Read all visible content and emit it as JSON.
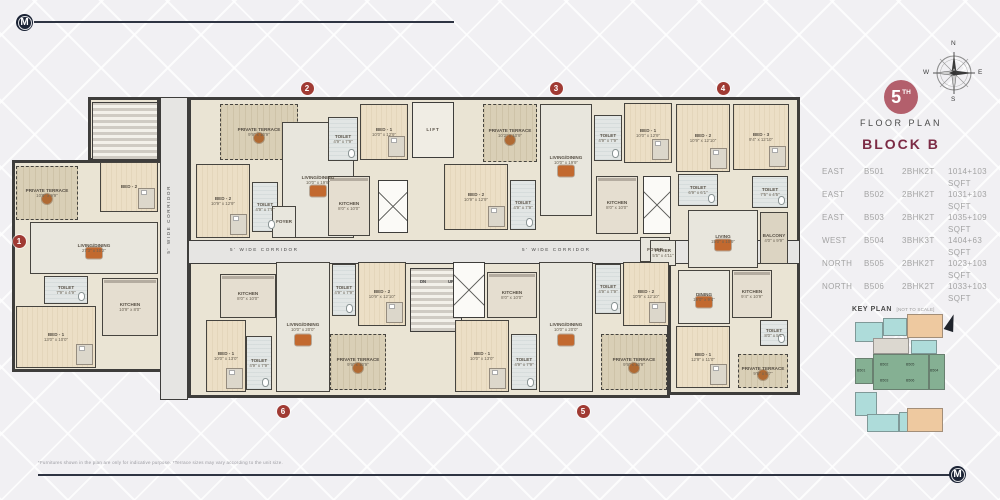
{
  "branding": {
    "logo_letter": "M"
  },
  "header": {
    "floor_number": "5",
    "floor_ordinal": "TH",
    "floor_caption": "FLOOR PLAN",
    "block_title": "BLOCK B"
  },
  "compass": {
    "north": "N",
    "east": "E",
    "south": "S",
    "west": "W"
  },
  "units_table": [
    {
      "facing": "EAST",
      "unit_no": "B501",
      "unit_type": "2BHK2T",
      "area": "1014+103 SQFT"
    },
    {
      "facing": "EAST",
      "unit_no": "B502",
      "unit_type": "2BHK2T",
      "area": "1031+103 SQFT"
    },
    {
      "facing": "EAST",
      "unit_no": "B503",
      "unit_type": "2BHK2T",
      "area": "1035+109 SQFT"
    },
    {
      "facing": "WEST",
      "unit_no": "B504",
      "unit_type": "3BHK3T",
      "area": "1404+63 SQFT"
    },
    {
      "facing": "NORTH",
      "unit_no": "B505",
      "unit_type": "2BHK2T",
      "area": "1023+103 SQFT"
    },
    {
      "facing": "NORTH",
      "unit_no": "B506",
      "unit_type": "2BHK2T",
      "area": "1033+103 SQFT"
    }
  ],
  "key_plan": {
    "title": "KEY PLAN",
    "subtitle": "[NOT TO SCALE]",
    "north_label": "N",
    "blocks": [
      {
        "x": 2,
        "y": 10,
        "w": 28,
        "h": 20,
        "c": "cyan"
      },
      {
        "x": 30,
        "y": 6,
        "w": 24,
        "h": 18,
        "c": "cyan"
      },
      {
        "x": 54,
        "y": 2,
        "w": 36,
        "h": 24,
        "c": "orange"
      },
      {
        "x": 20,
        "y": 26,
        "w": 36,
        "h": 16,
        "c": "gray"
      },
      {
        "x": 58,
        "y": 28,
        "w": 26,
        "h": 14,
        "c": "cyan"
      },
      {
        "x": 2,
        "y": 46,
        "w": 18,
        "h": 26,
        "c": "green"
      },
      {
        "x": 20,
        "y": 42,
        "w": 56,
        "h": 36,
        "c": "green"
      },
      {
        "x": 76,
        "y": 42,
        "w": 16,
        "h": 36,
        "c": "green"
      },
      {
        "x": 2,
        "y": 80,
        "w": 22,
        "h": 24,
        "c": "cyan"
      },
      {
        "x": 46,
        "y": 100,
        "w": 26,
        "h": 20,
        "c": "cyan"
      },
      {
        "x": 14,
        "y": 102,
        "w": 32,
        "h": 18,
        "c": "cyan"
      },
      {
        "x": 54,
        "y": 96,
        "w": 36,
        "h": 24,
        "c": "orange"
      }
    ],
    "labels": [
      {
        "t": "B501",
        "x": 4,
        "y": 56
      },
      {
        "t": "B502",
        "x": 27,
        "y": 50
      },
      {
        "t": "B505",
        "x": 53,
        "y": 50
      },
      {
        "t": "B503",
        "x": 27,
        "y": 66
      },
      {
        "t": "B506",
        "x": 53,
        "y": 66
      },
      {
        "t": "B504",
        "x": 77,
        "y": 56
      }
    ]
  },
  "floor_plan": {
    "corridor_label": "5' WIDE CORRIDOR",
    "lift_label": "LIFT",
    "stair_labels": [
      {
        "t": "DN",
        "x": 420,
        "y": 279
      },
      {
        "t": "UP",
        "x": 448,
        "y": 279
      }
    ],
    "badges": [
      {
        "n": "1",
        "x": 19,
        "y": 241
      },
      {
        "n": "2",
        "x": 307,
        "y": 88
      },
      {
        "n": "3",
        "x": 556,
        "y": 88
      },
      {
        "n": "4",
        "x": 723,
        "y": 88
      },
      {
        "n": "5",
        "x": 583,
        "y": 411
      },
      {
        "n": "6",
        "x": 283,
        "y": 411
      }
    ],
    "blocks": [
      {
        "x": 88,
        "y": 97,
        "w": 72,
        "h": 64
      },
      {
        "x": 188,
        "y": 97,
        "w": 612,
        "h": 146
      },
      {
        "x": 12,
        "y": 160,
        "w": 176,
        "h": 212
      },
      {
        "x": 188,
        "y": 258,
        "w": 482,
        "h": 140
      },
      {
        "x": 668,
        "y": 243,
        "w": 132,
        "h": 152
      }
    ],
    "corridors": [
      {
        "x": 160,
        "y": 97,
        "w": 28,
        "h": 303
      },
      {
        "x": 188,
        "y": 240,
        "w": 612,
        "h": 24
      }
    ],
    "corridor_labels": [
      {
        "x": 230,
        "y": 247,
        "v": false
      },
      {
        "x": 522,
        "y": 247,
        "v": false
      },
      {
        "x": 166,
        "y": 185,
        "v": true
      }
    ],
    "cores": [
      {
        "kind": "lift",
        "x": 412,
        "y": 102,
        "w": 42,
        "h": 56
      },
      {
        "kind": "stair",
        "x": 410,
        "y": 268,
        "w": 52,
        "h": 64
      },
      {
        "kind": "stair",
        "x": 92,
        "y": 102,
        "w": 66,
        "h": 58
      },
      {
        "kind": "shaft",
        "x": 378,
        "y": 180,
        "w": 30,
        "h": 53
      },
      {
        "kind": "shaft",
        "x": 643,
        "y": 176,
        "w": 28,
        "h": 58
      },
      {
        "kind": "shaft",
        "x": 453,
        "y": 262,
        "w": 32,
        "h": 56
      }
    ],
    "rooms": [
      {
        "u": 1,
        "k": "terrace",
        "n": "PRIVATE TERRACE",
        "d": "10'8\" x 9'9\"",
        "x": 16,
        "y": 166,
        "w": 62,
        "h": 54
      },
      {
        "u": 1,
        "k": "bed",
        "n": "BED - 2",
        "d": "",
        "x": 100,
        "y": 162,
        "w": 58,
        "h": 50
      },
      {
        "u": 1,
        "k": "living",
        "n": "LIVING/DINING",
        "d": "27'3\" x 10'2\"",
        "x": 30,
        "y": 222,
        "w": 128,
        "h": 52
      },
      {
        "u": 1,
        "k": "toilet",
        "n": "TOILET",
        "d": "7'9\" x 4'9\"",
        "x": 44,
        "y": 276,
        "w": 44,
        "h": 28
      },
      {
        "u": 1,
        "k": "bed",
        "n": "BED - 1",
        "d": "13'0\" x 10'0\"",
        "x": 16,
        "y": 306,
        "w": 80,
        "h": 62
      },
      {
        "u": 1,
        "k": "kitchen",
        "n": "KITCHEN",
        "d": "10'9\" x 8'0\"",
        "x": 102,
        "y": 278,
        "w": 56,
        "h": 58
      },
      {
        "u": 2,
        "k": "terrace",
        "n": "PRIVATE TERRACE",
        "d": "9'9\" x 10'9\"",
        "x": 220,
        "y": 104,
        "w": 78,
        "h": 56
      },
      {
        "u": 2,
        "k": "bed",
        "n": "BED - 2",
        "d": "10'9\" x 12'9\"",
        "x": 196,
        "y": 164,
        "w": 54,
        "h": 74
      },
      {
        "u": 2,
        "k": "toilet",
        "n": "TOILET",
        "d": "4'9\" x 7'9\"",
        "x": 252,
        "y": 182,
        "w": 26,
        "h": 50
      },
      {
        "u": 2,
        "k": "living",
        "n": "LIVING/DINING",
        "d": "10'0\" x 19'9\"",
        "x": 282,
        "y": 122,
        "w": 72,
        "h": 116
      },
      {
        "u": 2,
        "k": "toilet",
        "n": "TOILET",
        "d": "4'9\" x 7'9\"",
        "x": 328,
        "y": 117,
        "w": 30,
        "h": 44
      },
      {
        "u": 2,
        "k": "bed",
        "n": "BED - 1",
        "d": "10'0\" x 12'9\"",
        "x": 360,
        "y": 104,
        "w": 48,
        "h": 56
      },
      {
        "u": 2,
        "k": "kitchen",
        "n": "KITCHEN",
        "d": "8'0\" x 10'0\"",
        "x": 328,
        "y": 176,
        "w": 42,
        "h": 60
      },
      {
        "u": 2,
        "k": "foyer",
        "n": "FOYER",
        "d": "",
        "x": 272,
        "y": 206,
        "w": 24,
        "h": 32
      },
      {
        "u": 3,
        "k": "terrace",
        "n": "PRIVATE TERRACE",
        "d": "10'2\" x 10'9\"",
        "x": 483,
        "y": 104,
        "w": 54,
        "h": 58
      },
      {
        "u": 3,
        "k": "living",
        "n": "LIVING/DINING",
        "d": "10'0\" x 19'9\"",
        "x": 540,
        "y": 104,
        "w": 52,
        "h": 112
      },
      {
        "u": 3,
        "k": "toilet",
        "n": "TOILET",
        "d": "4'9\" x 7'9\"",
        "x": 594,
        "y": 115,
        "w": 28,
        "h": 46
      },
      {
        "u": 3,
        "k": "bed",
        "n": "BED - 1",
        "d": "10'0\" x 12'9\"",
        "x": 624,
        "y": 103,
        "w": 48,
        "h": 60
      },
      {
        "u": 3,
        "k": "bed",
        "n": "BED - 2",
        "d": "10'9\" x 12'9\"",
        "x": 444,
        "y": 164,
        "w": 64,
        "h": 66
      },
      {
        "u": 3,
        "k": "toilet",
        "n": "TOILET",
        "d": "4'9\" x 7'9\"",
        "x": 510,
        "y": 180,
        "w": 26,
        "h": 50
      },
      {
        "u": 3,
        "k": "kitchen",
        "n": "KITCHEN",
        "d": "8'0\" x 10'0\"",
        "x": 596,
        "y": 176,
        "w": 42,
        "h": 58
      },
      {
        "u": 3,
        "k": "foyer",
        "n": "FOYER",
        "d": "",
        "x": 640,
        "y": 237,
        "w": 30,
        "h": 25
      },
      {
        "u": 4,
        "k": "bed",
        "n": "BED - 2",
        "d": "10'9\" x 12'10\"",
        "x": 676,
        "y": 104,
        "w": 54,
        "h": 68
      },
      {
        "u": 4,
        "k": "bed",
        "n": "BED - 3",
        "d": "9'4\" x 12'10\"",
        "x": 733,
        "y": 104,
        "w": 56,
        "h": 66
      },
      {
        "u": 4,
        "k": "toilet",
        "n": "TOILET",
        "d": "6'9\" x 6'1\"",
        "x": 678,
        "y": 174,
        "w": 40,
        "h": 32
      },
      {
        "u": 4,
        "k": "toilet",
        "n": "TOILET",
        "d": "7'5\" x 4'5\"",
        "x": 752,
        "y": 176,
        "w": 36,
        "h": 32
      },
      {
        "u": 4,
        "k": "living",
        "n": "LIVING",
        "d": "15'0\" x 10'9\"",
        "x": 688,
        "y": 210,
        "w": 70,
        "h": 58
      },
      {
        "u": 4,
        "k": "balcony",
        "n": "BALCONY",
        "d": "4'0\" x 9'9\"",
        "x": 760,
        "y": 212,
        "w": 28,
        "h": 52
      },
      {
        "u": 4,
        "k": "living",
        "n": "DINING",
        "d": "19'0\" x 9'4\"",
        "x": 678,
        "y": 270,
        "w": 52,
        "h": 54
      },
      {
        "u": 4,
        "k": "kitchen",
        "n": "KITCHEN",
        "d": "9'4\" x 10'9\"",
        "x": 732,
        "y": 270,
        "w": 40,
        "h": 48
      },
      {
        "u": 4,
        "k": "bed",
        "n": "BED - 1",
        "d": "12'9\" x 11'0\"",
        "x": 676,
        "y": 326,
        "w": 54,
        "h": 62
      },
      {
        "u": 4,
        "k": "toilet",
        "n": "TOILET",
        "d": "8'0\" x 5'1\"",
        "x": 760,
        "y": 320,
        "w": 28,
        "h": 26
      },
      {
        "u": 4,
        "k": "terrace",
        "n": "PRIVATE TERRACE",
        "d": "9'9\" x 9'7\"",
        "x": 738,
        "y": 354,
        "w": 50,
        "h": 34
      },
      {
        "u": 4,
        "k": "foyer",
        "n": "FOYER",
        "d": "5'5\" x 4'11\"",
        "x": 650,
        "y": 240,
        "w": 26,
        "h": 26
      },
      {
        "u": 5,
        "k": "kitchen",
        "n": "KITCHEN",
        "d": "8'0\" x 10'0\"",
        "x": 487,
        "y": 272,
        "w": 50,
        "h": 46
      },
      {
        "u": 5,
        "k": "bed",
        "n": "BED - 1",
        "d": "10'0\" x 13'0\"",
        "x": 455,
        "y": 320,
        "w": 54,
        "h": 72
      },
      {
        "u": 5,
        "k": "toilet",
        "n": "TOILET",
        "d": "4'9\" x 7'9\"",
        "x": 511,
        "y": 334,
        "w": 26,
        "h": 56
      },
      {
        "u": 5,
        "k": "living",
        "n": "LIVING/DINING",
        "d": "10'0\" x 20'0\"",
        "x": 539,
        "y": 262,
        "w": 54,
        "h": 130
      },
      {
        "u": 5,
        "k": "toilet",
        "n": "TOILET",
        "d": "4'9\" x 7'9\"",
        "x": 595,
        "y": 264,
        "w": 26,
        "h": 50
      },
      {
        "u": 5,
        "k": "bed",
        "n": "BED - 2",
        "d": "10'9\" x 12'10\"",
        "x": 623,
        "y": 262,
        "w": 46,
        "h": 64
      },
      {
        "u": 5,
        "k": "terrace",
        "n": "PRIVATE TERRACE",
        "d": "9'9\" x 10'9\"",
        "x": 601,
        "y": 334,
        "w": 66,
        "h": 56
      },
      {
        "u": 6,
        "k": "kitchen",
        "n": "KITCHEN",
        "d": "8'0\" x 10'0\"",
        "x": 220,
        "y": 274,
        "w": 56,
        "h": 44
      },
      {
        "u": 6,
        "k": "bed",
        "n": "BED - 1",
        "d": "10'0\" x 13'0\"",
        "x": 206,
        "y": 320,
        "w": 40,
        "h": 72
      },
      {
        "u": 6,
        "k": "toilet",
        "n": "TOILET",
        "d": "4'9\" x 7'9\"",
        "x": 246,
        "y": 336,
        "w": 26,
        "h": 54
      },
      {
        "u": 6,
        "k": "living",
        "n": "LIVING/DINING",
        "d": "10'0\" x 20'0\"",
        "x": 276,
        "y": 262,
        "w": 54,
        "h": 130
      },
      {
        "u": 6,
        "k": "toilet",
        "n": "TOILET",
        "d": "4'9\" x 7'9\"",
        "x": 332,
        "y": 264,
        "w": 24,
        "h": 52
      },
      {
        "u": 6,
        "k": "bed",
        "n": "BED - 2",
        "d": "10'9\" x 12'10\"",
        "x": 358,
        "y": 262,
        "w": 48,
        "h": 64
      },
      {
        "u": 6,
        "k": "terrace",
        "n": "PRIVATE TERRACE",
        "d": "9'9\" x 10'9\"",
        "x": 330,
        "y": 334,
        "w": 56,
        "h": 56
      }
    ]
  },
  "footer": {
    "disclaimer": "*Furnitures shown in the plan are only for indicative purpose. *Terrace sizes may vary according to the unit size."
  }
}
